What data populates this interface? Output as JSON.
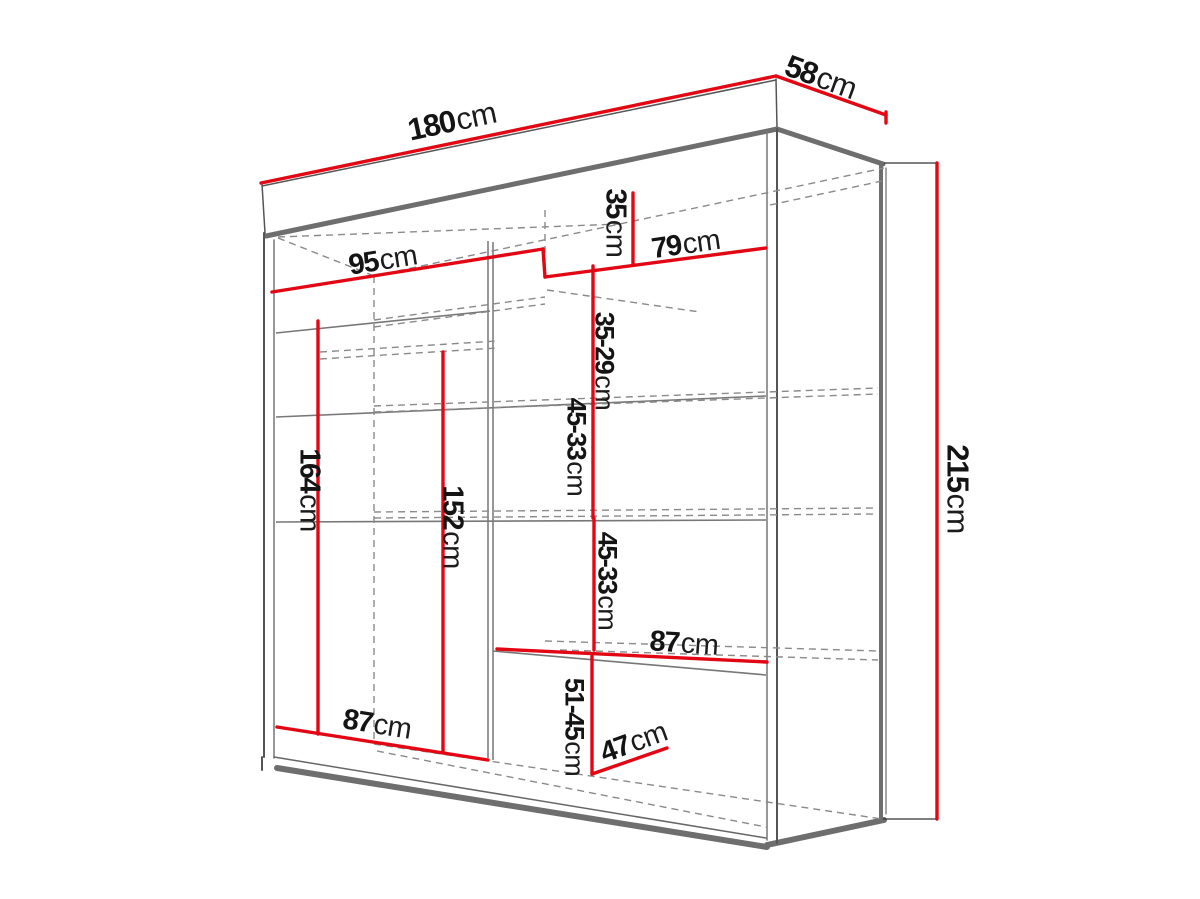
{
  "diagram": {
    "type": "furniture-dimension-drawing",
    "object": "sliding-door wardrobe, perspective line drawing",
    "colors": {
      "dimension_line": "#e30613",
      "outline": "#6a6a6a",
      "hidden_line": "#8a8a8a",
      "label_text": "#141414",
      "background": "#ffffff"
    },
    "labels": {
      "total_width": {
        "value": "180",
        "unit": "cm"
      },
      "total_depth": {
        "value": "58",
        "unit": "cm"
      },
      "total_height": {
        "value": "215",
        "unit": "cm"
      },
      "left_door_width": {
        "value": "95",
        "unit": "cm"
      },
      "right_door_width": {
        "value": "79",
        "unit": "cm"
      },
      "top_section_height": {
        "value": "35",
        "unit": "cm"
      },
      "shelf_gap_1": {
        "value": "35-29",
        "unit": "cm"
      },
      "shelf_gap_2": {
        "value": "45-33",
        "unit": "cm"
      },
      "shelf_gap_3": {
        "value": "45-33",
        "unit": "cm"
      },
      "mid_shelf_width": {
        "value": "87",
        "unit": "cm"
      },
      "bottom_width": {
        "value": "87",
        "unit": "cm"
      },
      "shelf_depth": {
        "value": "47",
        "unit": "cm"
      },
      "bottom_gap": {
        "value": "51-45",
        "unit": "cm"
      }
    }
  }
}
